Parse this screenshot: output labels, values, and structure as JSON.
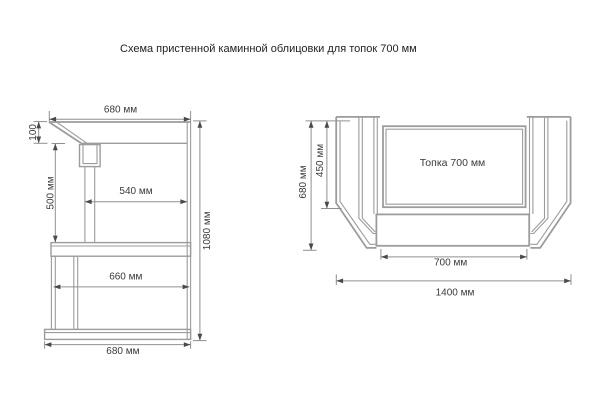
{
  "title": "Схема пристенной каминной облицовки для топок 700 мм",
  "colors": {
    "structure_line": "#9c9c9c",
    "dimension_line": "#909090",
    "arrow": "#4a4a4a",
    "text": "#3a3a3a",
    "background": "#ffffff"
  },
  "side_view": {
    "dims": {
      "top_width": "680 мм",
      "hood_height": "100",
      "opening_height": "500 мм",
      "depth": "540 мм",
      "lower_width": "660 мм",
      "base_width": "680 мм",
      "total_height": "1080 мм"
    }
  },
  "front_view": {
    "firebox_label": "Топка 700 мм",
    "dims": {
      "total_height": "680 мм",
      "opening_height": "450 мм",
      "firebox_width": "700 мм",
      "total_width": "1400 мм"
    }
  }
}
